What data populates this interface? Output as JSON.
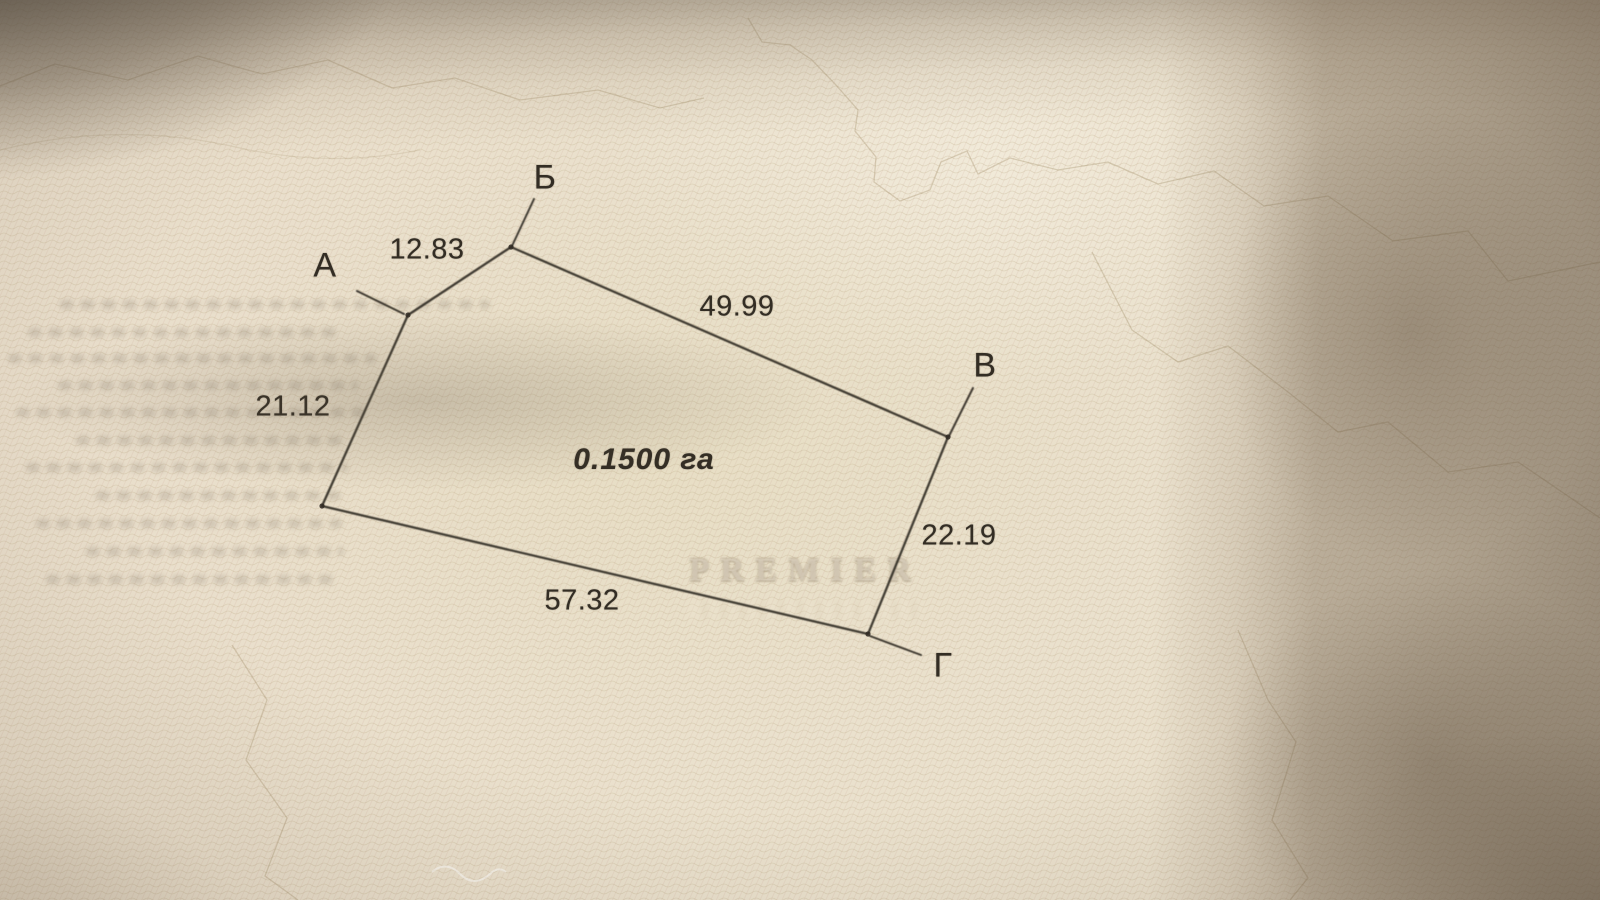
{
  "plan": {
    "area_label": "0.1500 га",
    "vertices": {
      "a": "А",
      "b": "Б",
      "v": "В",
      "g": "Г"
    },
    "lengths": {
      "ab": "12.83",
      "bv": "49.99",
      "vg": "22.19",
      "gd": "57.32",
      "da": "21.12"
    }
  },
  "watermark": {
    "line1": "PREMIER"
  },
  "colors": {
    "paper": "#eae1cd",
    "ink": "#2f2922",
    "pattern_line": "#a5946f",
    "shadow": "#6d5c49",
    "watermark_text": "#f6efe0"
  }
}
